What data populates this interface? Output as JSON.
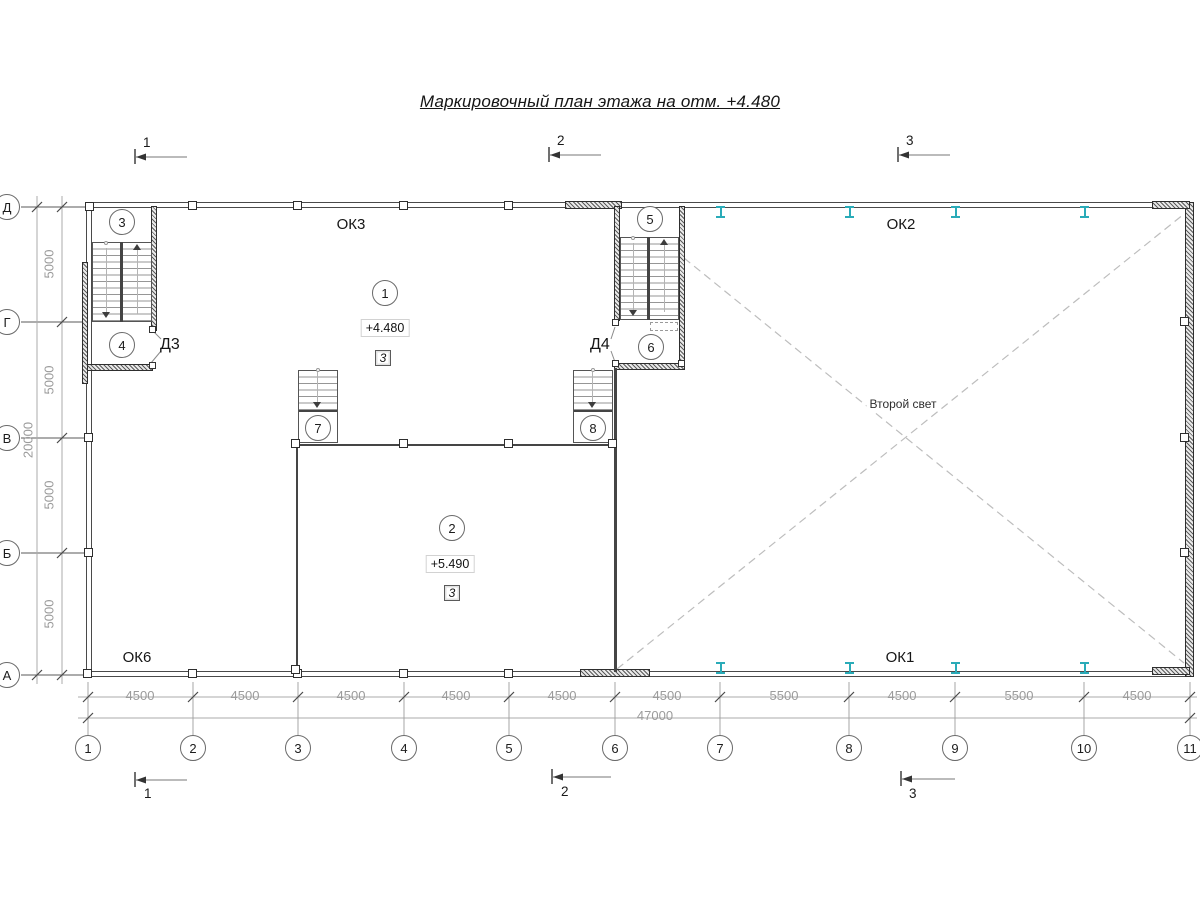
{
  "title": "Маркировочный план этажа на отм. +4.480",
  "sections": {
    "top": [
      "1",
      "2",
      "3"
    ],
    "bottom": [
      "1",
      "2",
      "3"
    ]
  },
  "grid": {
    "cols": [
      "1",
      "2",
      "3",
      "4",
      "5",
      "6",
      "7",
      "8",
      "9",
      "10",
      "11"
    ],
    "rows": [
      "Д",
      "Г",
      "В",
      "Б",
      "А"
    ]
  },
  "dims": {
    "bottom": [
      "4500",
      "4500",
      "4500",
      "4500",
      "4500",
      "4500",
      "5500",
      "4500",
      "5500",
      "4500"
    ],
    "bottom_total": "47000",
    "left": [
      "5000",
      "5000",
      "5000",
      "5000"
    ],
    "left_total": "20000"
  },
  "labels": {
    "ok3": "ОК3",
    "ok2": "ОК2",
    "ok6": "ОК6",
    "ok1": "ОК1",
    "d3": "Д3",
    "d4": "Д4",
    "second_light": "Второй свет"
  },
  "marks": [
    "1",
    "2",
    "3",
    "4",
    "5",
    "6",
    "7",
    "8"
  ],
  "elevations": {
    "upper": "+4.480",
    "lower": "+5.490"
  },
  "type_boxes": [
    "3",
    "3"
  ],
  "colors": {
    "steel_column": "#2aabb8",
    "line_dark": "#4a4a4a",
    "dim_gray": "#9b9b9b",
    "dashed_gray": "#bdbdbd"
  }
}
